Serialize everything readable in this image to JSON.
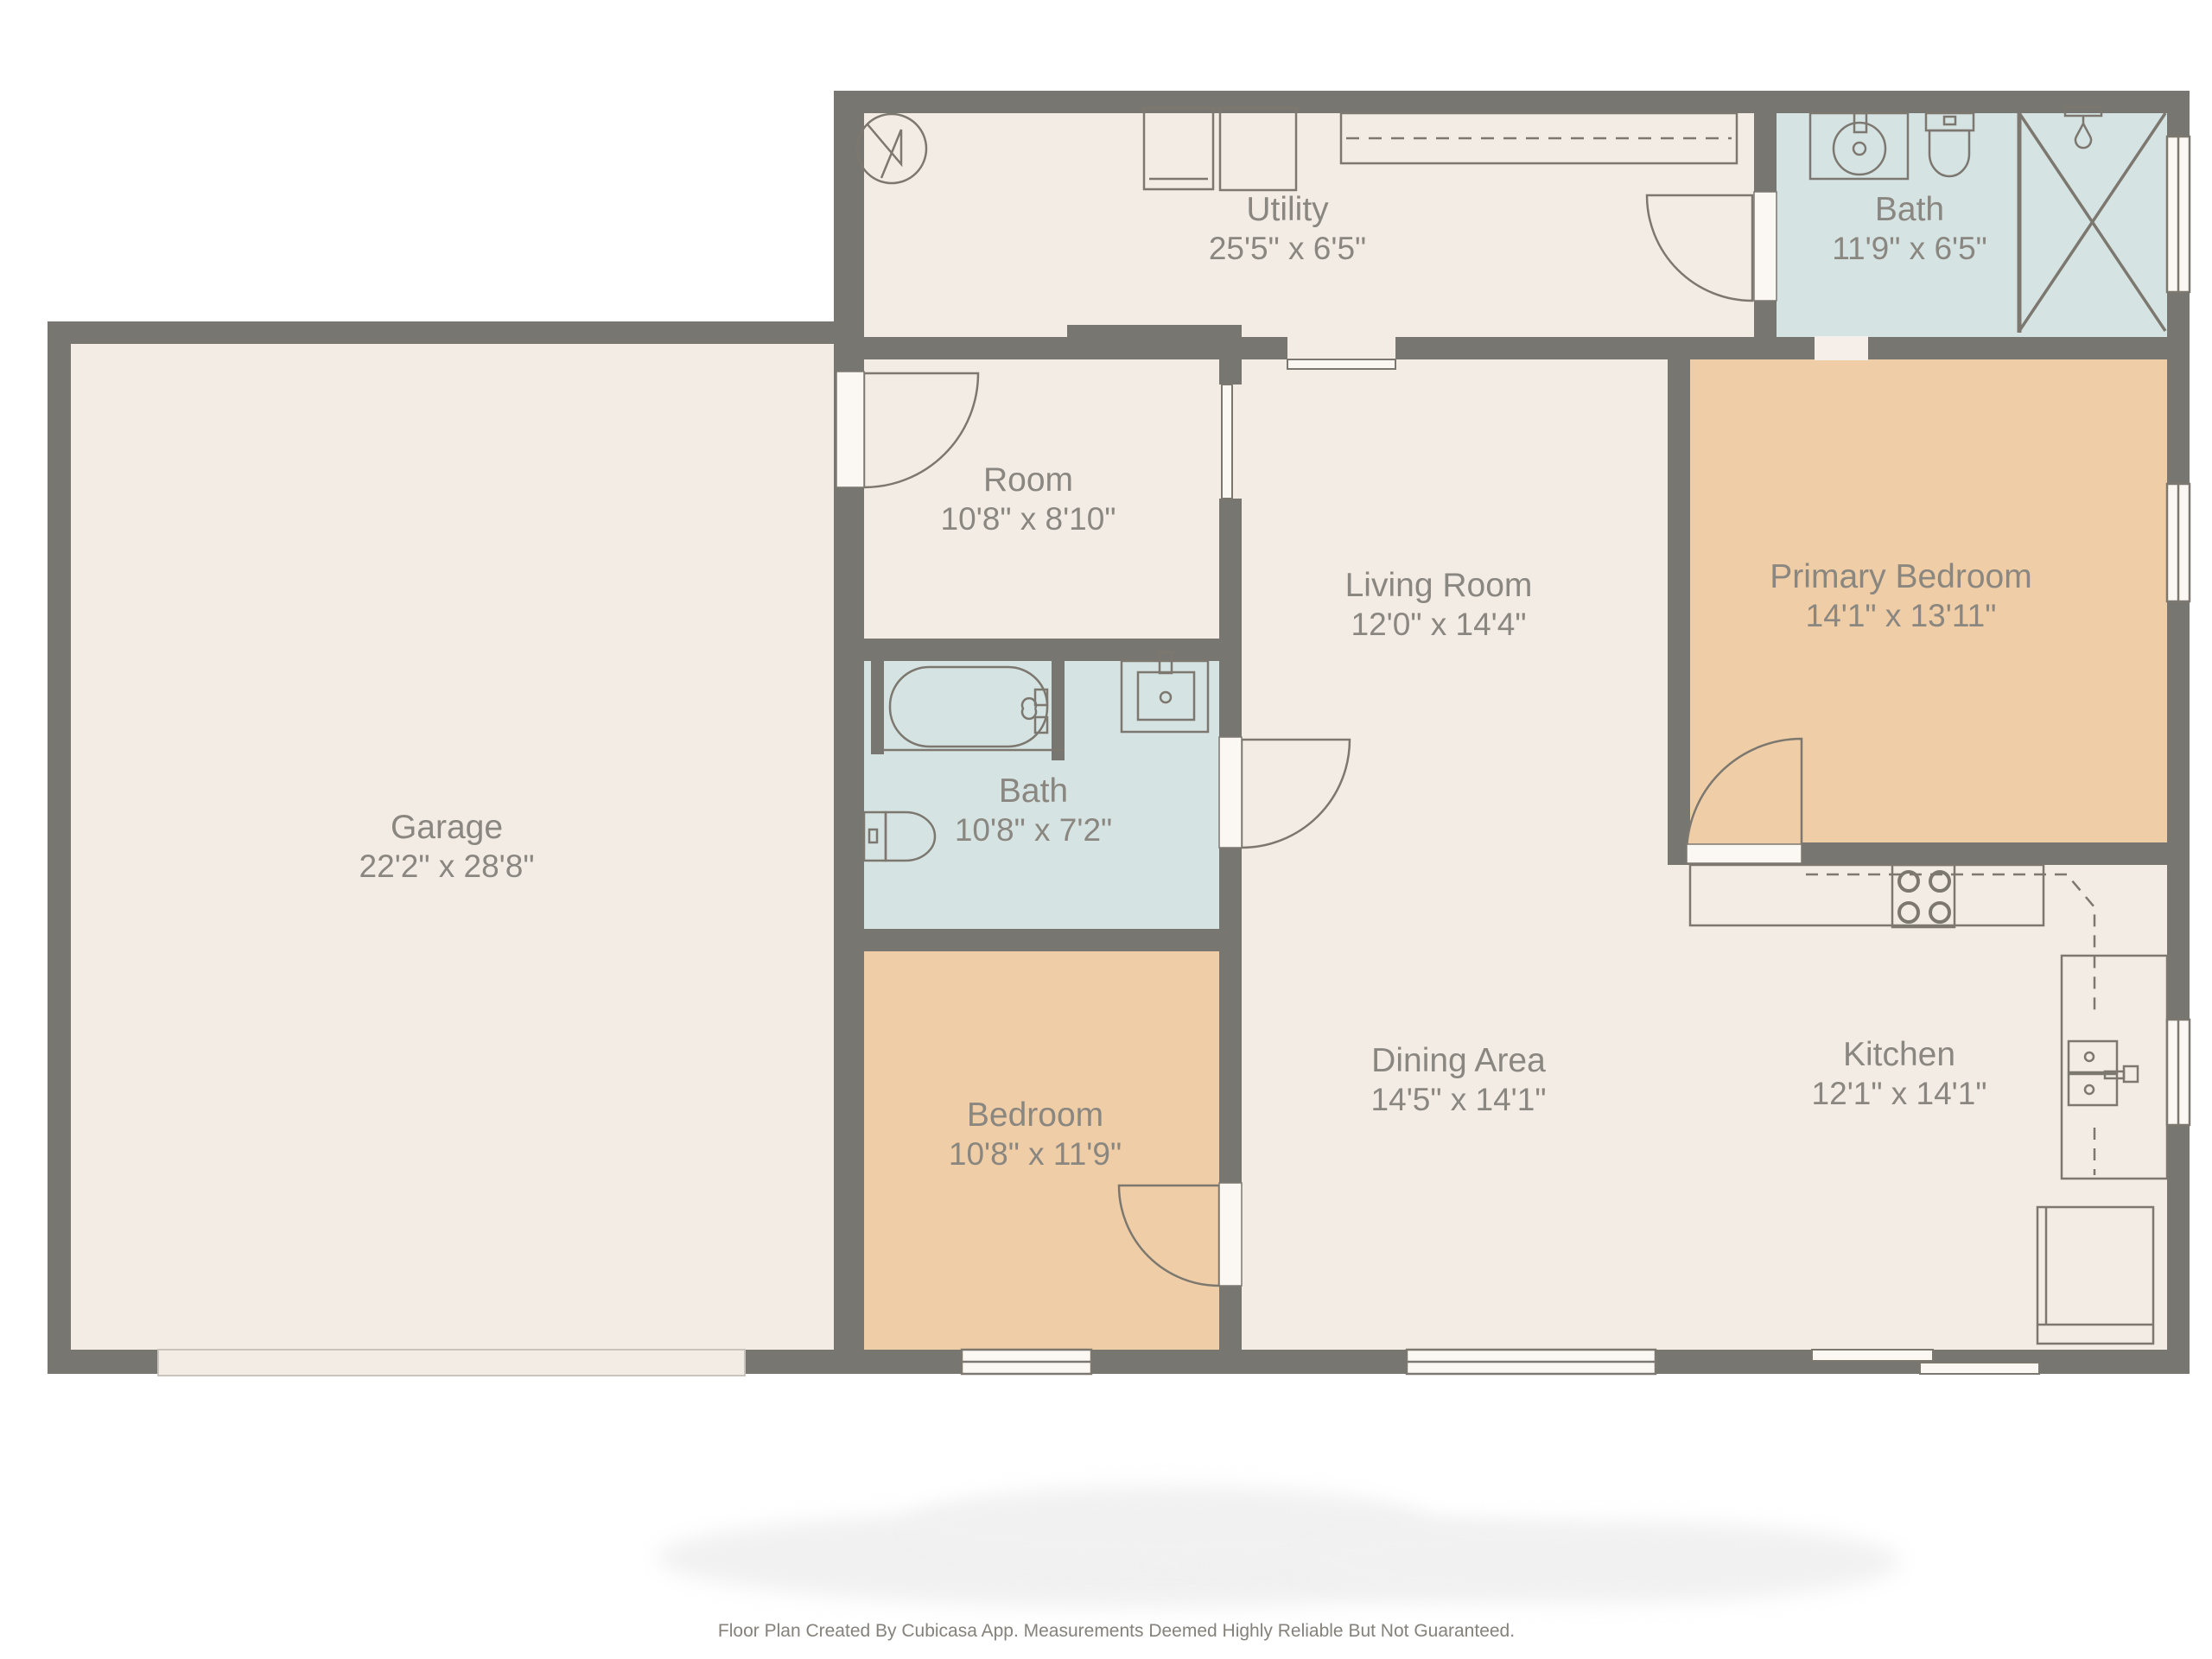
{
  "floorplan": {
    "title": "Single-story house floor plan",
    "rooms": {
      "garage": {
        "name": "Garage",
        "dims": "22'2\" x 28'8\""
      },
      "utility": {
        "name": "Utility",
        "dims": "25'5\" x 6'5\""
      },
      "bath_top": {
        "name": "Bath",
        "dims": "11'9\" x 6'5\""
      },
      "room": {
        "name": "Room",
        "dims": "10'8\" x 8'10\""
      },
      "living": {
        "name": "Living Room",
        "dims": "12'0\" x 14'4\""
      },
      "primary_bedroom": {
        "name": "Primary Bedroom",
        "dims": "14'1\" x 13'11\""
      },
      "bath_mid": {
        "name": "Bath",
        "dims": "10'8\" x 7'2\""
      },
      "bedroom": {
        "name": "Bedroom",
        "dims": "10'8\" x 11'9\""
      },
      "dining": {
        "name": "Dining Area",
        "dims": "14'5\" x 14'1\""
      },
      "kitchen": {
        "name": "Kitchen",
        "dims": "12'1\" x 14'1\""
      }
    },
    "fixtures": [
      "water-heater-icon",
      "washer-icon",
      "dryer-icon",
      "utility-counter-icon",
      "bathroom-sink-icon",
      "toilet-icon",
      "shower-icon",
      "bathtub-icon",
      "stove-icon",
      "kitchen-sink-icon",
      "refrigerator-icon",
      "door-swing-icon",
      "window-icon",
      "sliding-door-icon",
      "garage-door-icon",
      "wall-opening-icon",
      "upper-cabinet-dashed-line"
    ],
    "colors": {
      "wall": "#787671",
      "floor": "#F3ECE5",
      "bathroom_floor": "#D6E3E3",
      "bedroom_floor": "#EFCDA6",
      "fixture_fill": "#FBF8F4",
      "fixture_line": "#7C7870",
      "label_text": "#8A8680",
      "background": "#FFFFFF"
    },
    "footer": {
      "disclaimer": "Floor Plan Created By Cubicasa App. Measurements Deemed Highly Reliable But Not Guaranteed."
    }
  }
}
